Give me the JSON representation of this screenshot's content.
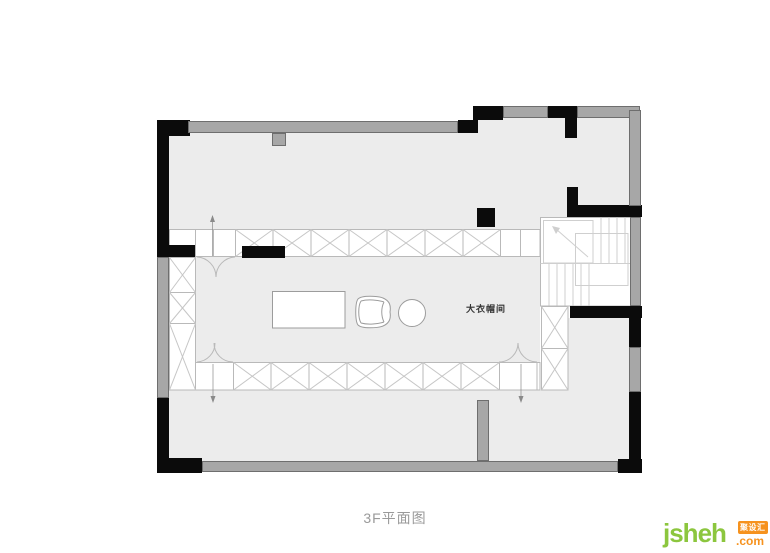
{
  "title": "3F平面图",
  "rooms": {
    "walk_in_closet_label": "大衣帽间"
  },
  "watermark": {
    "brand": "jsheh",
    "tld": ".com",
    "badge": "聚设汇"
  },
  "colors": {
    "floor": "#ececec",
    "wall_gray": "#a7a7a7",
    "wall_black": "#0b0b0b",
    "cabinet_line": "#b9b9b9",
    "hatch_line": "#c6c6c6",
    "stair_line": "#cfcfcf",
    "furniture_line": "#9c9c9c",
    "marker_line": "#8a8a8a",
    "title_text": "#9a9a9a",
    "label_text": "#333333",
    "brand_green": "#8cc63e",
    "brand_orange": "#f6921e"
  }
}
